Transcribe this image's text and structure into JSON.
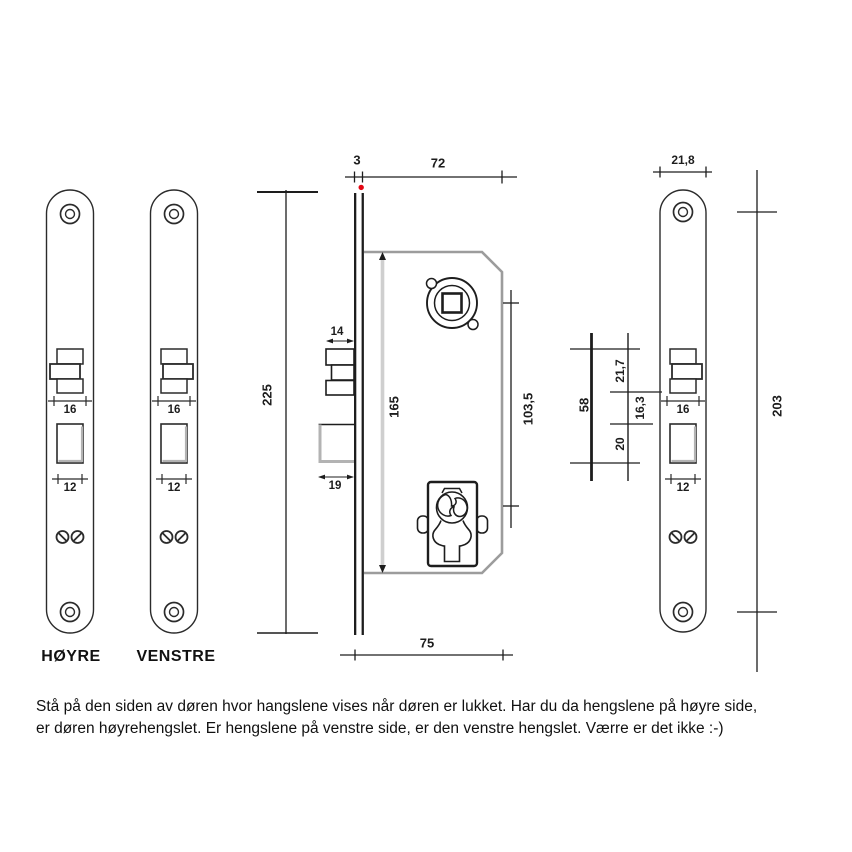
{
  "plates": {
    "hoyre": {
      "label": "HØYRE",
      "latch_width": "16",
      "bolt_width": "12"
    },
    "venstre": {
      "label": "VENSTRE",
      "latch_width": "16",
      "bolt_width": "12"
    },
    "detail": {
      "width": "21,8",
      "height": "203",
      "latch_width": "16",
      "bolt_width": "12"
    }
  },
  "lock": {
    "faceplate_thickness": "3",
    "total_depth": "72",
    "faceplate_height": "225",
    "body_height": "165",
    "spindle_to_cylinder": "103,5",
    "latch_protrusion": "14",
    "bolt_protrusion": "19",
    "body_depth": "75"
  },
  "cutout_spacing": {
    "total": "58",
    "latch_height": "21,7",
    "gap": "16,3",
    "bolt_height": "20"
  },
  "colors": {
    "line": "#1d1d1d",
    "body_gray": "#9c9c9c",
    "dim_band_gray": "#cfcfcf",
    "shade_gray": "#b3b3b3",
    "red_dot": "#e30613"
  },
  "footer": {
    "line1": "Stå på den siden av døren hvor hangslene vises når døren er lukket. Har du da hengslene på høyre side,",
    "line2": "er døren høyrehengslet. Er hengslene på venstre side, er den venstre hengslet. Værre er det ikke :-)"
  }
}
